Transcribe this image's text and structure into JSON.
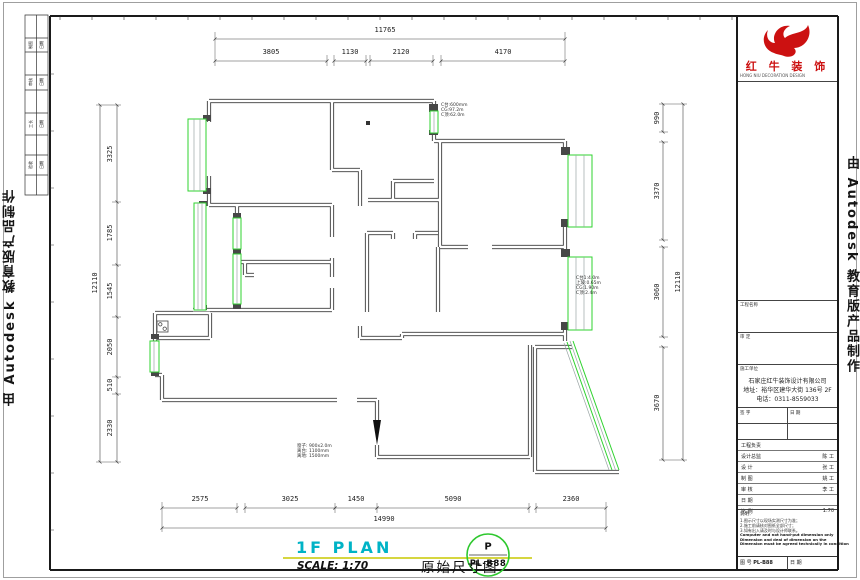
{
  "watermarks": {
    "left": "由 Autodesk 教育版产品制作",
    "right": "由 Autodesk 教育版产品制作"
  },
  "brand": {
    "name": "红 牛 装 饰",
    "tagline": "HONG NIU DECORATION DESIGN",
    "color": "#cc1111"
  },
  "plan_title": {
    "name": "1F PLAN",
    "scale": "SCALE: 1:70",
    "drawing": "原始尺寸图",
    "stamp_letter": "P",
    "stamp_code": "PL-B88"
  },
  "colors": {
    "accent_cyan": "#00b3c6",
    "underline_yellow": "#c9c900",
    "window_green": "#2fd32f",
    "stamp_green": "#2ec82e",
    "logo_red": "#cc1111"
  },
  "dim_labels": [
    {
      "text": "11765",
      "x": 385,
      "y": 30,
      "rot": 0,
      "group": "top-overall"
    },
    {
      "text": "3805",
      "x": 271,
      "y": 52,
      "rot": 0,
      "group": "top"
    },
    {
      "text": "1130",
      "x": 350,
      "y": 52,
      "rot": 0,
      "group": "top"
    },
    {
      "text": "2120",
      "x": 401,
      "y": 52,
      "rot": 0,
      "group": "top"
    },
    {
      "text": "4170",
      "x": 503,
      "y": 52,
      "rot": 0,
      "group": "top"
    },
    {
      "text": "2575",
      "x": 200,
      "y": 499,
      "rot": 0,
      "group": "bottom"
    },
    {
      "text": "3025",
      "x": 290,
      "y": 499,
      "rot": 0,
      "group": "bottom"
    },
    {
      "text": "1450",
      "x": 356,
      "y": 499,
      "rot": 0,
      "group": "bottom"
    },
    {
      "text": "5090",
      "x": 453,
      "y": 499,
      "rot": 0,
      "group": "bottom"
    },
    {
      "text": "2360",
      "x": 571,
      "y": 499,
      "rot": 0,
      "group": "bottom"
    },
    {
      "text": "14990",
      "x": 384,
      "y": 519,
      "rot": 0,
      "group": "bottom-overall"
    },
    {
      "text": "12110",
      "x": 95,
      "y": 283,
      "rot": -90,
      "group": "left-overall"
    },
    {
      "text": "3325",
      "x": 110,
      "y": 154,
      "rot": -90,
      "group": "left"
    },
    {
      "text": "1785",
      "x": 110,
      "y": 233,
      "rot": -90,
      "group": "left"
    },
    {
      "text": "1545",
      "x": 110,
      "y": 291,
      "rot": -90,
      "group": "left"
    },
    {
      "text": "2050",
      "x": 110,
      "y": 347,
      "rot": -90,
      "group": "left"
    },
    {
      "text": "510",
      "x": 110,
      "y": 385,
      "rot": -90,
      "group": "left"
    },
    {
      "text": "2330",
      "x": 110,
      "y": 428,
      "rot": -90,
      "group": "left"
    },
    {
      "text": "990",
      "x": 657,
      "y": 118,
      "rot": -90,
      "group": "right"
    },
    {
      "text": "3370",
      "x": 657,
      "y": 191,
      "rot": -90,
      "group": "right"
    },
    {
      "text": "3060",
      "x": 657,
      "y": 292,
      "rot": -90,
      "group": "right"
    },
    {
      "text": "3670",
      "x": 657,
      "y": 403,
      "rot": -90,
      "group": "right"
    },
    {
      "text": "12110",
      "x": 678,
      "y": 282,
      "rot": -90,
      "group": "right-overall"
    }
  ],
  "annotations": [
    {
      "x": 441,
      "y": 103,
      "lines": [
        "C台:600mm",
        "CG:97.2m",
        "C顶:62.0m"
      ]
    },
    {
      "x": 576,
      "y": 276,
      "lines": [
        "C台1:4.0m",
        "上玻:0.65m",
        "CG:1.90m",
        "C顶:2.4m"
      ]
    },
    {
      "x": 297,
      "y": 444,
      "lines": [
        "窗子: 900x2.0m",
        "离台: 1100mm",
        "离地: 1500mm"
      ]
    }
  ],
  "strip_cells": [
    {
      "t": "制图",
      "x": 31,
      "y": 45
    },
    {
      "t": "日期",
      "x": 42,
      "y": 45
    },
    {
      "t": "审核",
      "x": 31,
      "y": 82
    },
    {
      "t": "日期",
      "x": 42,
      "y": 82
    },
    {
      "t": "工长",
      "x": 31,
      "y": 124
    },
    {
      "t": "日期",
      "x": 42,
      "y": 124
    },
    {
      "t": "验收",
      "x": 31,
      "y": 165
    },
    {
      "t": "日期",
      "x": 42,
      "y": 165
    }
  ],
  "title_block": {
    "project_label": "工程名称",
    "approve_label": "审 定",
    "company_label": "施工单位",
    "company_lines": [
      "石家庄红牛装饰设计有限公司",
      "地址：裕华区建华大街 136号 2F",
      "电话：0311-8559033"
    ],
    "sign_label": "签 字",
    "date_label": "日 期",
    "rows": [
      {
        "label": "工程负责",
        "value": ""
      },
      {
        "label": "设计总监",
        "value": "陈 工"
      },
      {
        "label": "设 计",
        "value": "张 工"
      },
      {
        "label": "制 图",
        "value": "姚 工"
      },
      {
        "label": "审 核",
        "value": "李 工"
      },
      {
        "label": "日 期",
        "value": ""
      },
      {
        "label": "比 例",
        "value": "1:70"
      }
    ],
    "notes_title": "说明：",
    "notes_cn": [
      "1.图示尺寸以现场实测尺寸为准；",
      "2.施工前请核对图纸全部尺寸；",
      "3.如有出入请及时与设计师联系。"
    ],
    "notes_en": [
      "Computer and not hand-put dimension only",
      "Dimension and deal of dimension on the",
      "Dimension must be agreed technically in condition"
    ],
    "footer_left_label": "图 号",
    "footer_left_value": "PL-B88",
    "footer_right_label": "日 期",
    "footer_right_value": ""
  }
}
